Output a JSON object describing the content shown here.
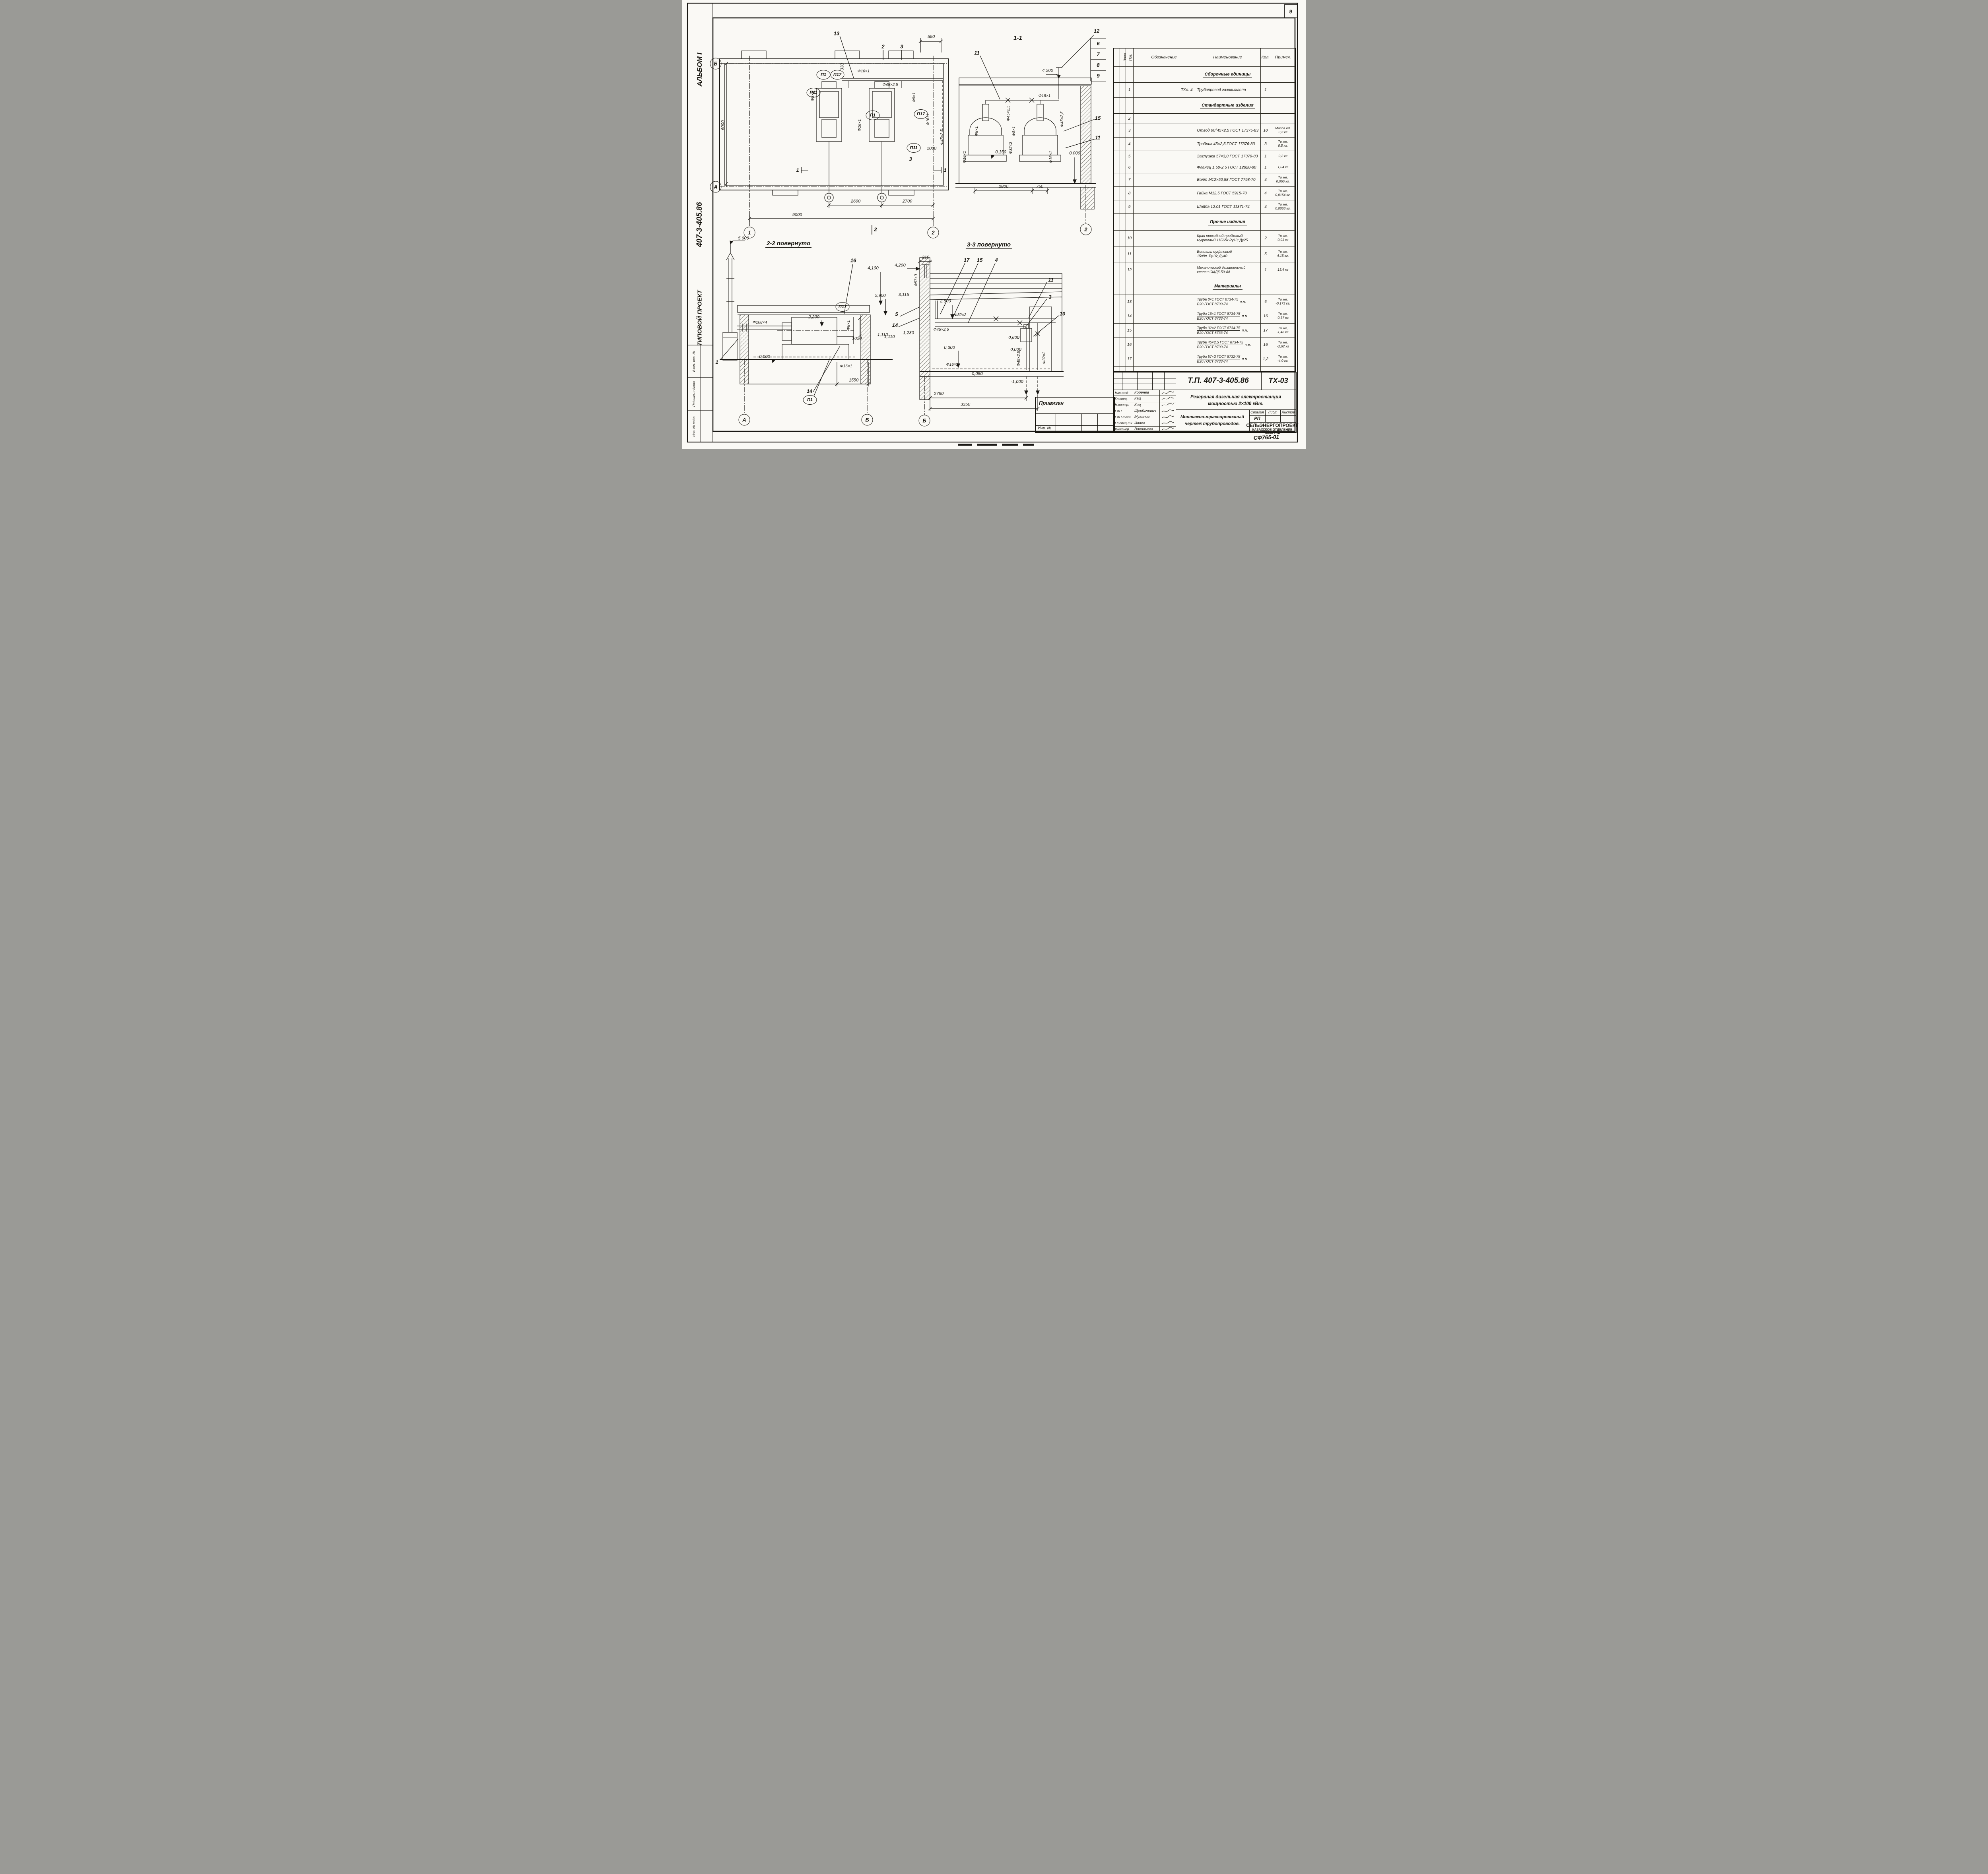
{
  "sheet": {
    "page_number": "9",
    "stamp_code": "СФ765-01"
  },
  "left_strip": {
    "album": "АЛЬБОМ I",
    "project": "407-3-405.86",
    "type": "ТИПОВОЙ ПРОЕКТ",
    "rows": [
      "Взам. инв. №",
      "Подпись и дата",
      "Инв. № подл."
    ]
  },
  "plan": {
    "c13": "13",
    "s2t": "2",
    "s3t": "3",
    "d550": "550",
    "d330": "330",
    "p16a": "Ф16×1",
    "p45a": "Ф45×2,5",
    "p8a": "Ф8×1",
    "p8b": "Ф8×1",
    "p16b": "Ф16×1",
    "p16c": "Ф16×1",
    "p45b": "Ф45×2,5",
    "u1a": "П1",
    "u17a": "П17",
    "u11a": "П11",
    "u1b": "П1",
    "u17b": "П17",
    "u11b": "П11",
    "d1000": "1000",
    "s1l": "1",
    "s1r": "1",
    "s3m": "3",
    "s2b": "2",
    "d2600": "2600",
    "d2700": "2700",
    "d9000": "9000",
    "d6000": "6000",
    "axB": "Б",
    "axA": "А",
    "ax1": "1",
    "ax2": "2"
  },
  "s11": {
    "title": "1-1",
    "c12": "12",
    "n6": "6",
    "n7": "7",
    "n8": "8",
    "n9": "9",
    "e4200": "4,200",
    "c11a": "11",
    "p18": "Ф18×1",
    "p45a": "Ф45×2,5",
    "p45b": "Ф45×2,5",
    "p8a": "Ф8×1",
    "p8b": "Ф8×1",
    "p32": "Ф32×2",
    "p16a": "Ф16×1",
    "p16b": "Ф16×1",
    "e0150": "0,150",
    "e0000": "0,000",
    "c15": "15",
    "c11b": "11",
    "d2800": "2800",
    "d750": "750",
    "ax2": "2"
  },
  "s22": {
    "title": "2-2 повернуто",
    "e5600": "5,600",
    "c16": "16",
    "e4100": "4,100",
    "e2900": "2,900",
    "u17": "П17",
    "e2200": "2,200",
    "p108": "Ф108×4",
    "p8": "Ф8×1",
    "d1020": "1020",
    "e1110": "1,110",
    "e0000": "0,000",
    "p16": "Ф16×1",
    "d1550": "1550",
    "u1": "П1",
    "c14": "14",
    "c1": "1",
    "axA": "А",
    "axB": "Б"
  },
  "s33": {
    "title": "3-3 повернуто",
    "e4200": "4,200",
    "d210": "210",
    "c17": "17",
    "c15": "15",
    "c4": "4",
    "p57": "Ф57×3",
    "e3115": "3,115",
    "e2500": "2,500",
    "c5": "5",
    "c14": "14",
    "c11": "11",
    "c3": "3",
    "c10": "10",
    "e1230": "1,230",
    "e1110": "1,110",
    "p32a": "Ф32×2",
    "p45a": "Ф45×2,5",
    "e0600": "0,600",
    "e0300": "0,300",
    "e0000": "0,000",
    "p16": "Ф16×1",
    "em0050": "-0,050",
    "p45b": "Ф45×2,5",
    "p32b": "Ф32×2",
    "em1000": "-1,000",
    "d2790": "2790",
    "d3350": "3350",
    "axB": "Б"
  },
  "spec": {
    "headers": {
      "format": "Формат",
      "zone": "Зона",
      "pos": "Поз.",
      "desig": "Обозначение",
      "name": "Наименование",
      "qty": "Кол.",
      "note": "Примеч."
    },
    "rows": [
      {
        "sec": "Сборочные единицы"
      },
      {
        "pos": "1",
        "desig": "ТХл. 4",
        "n1": "Трубопровод газовыхлопа",
        "qty": "1"
      },
      {
        "sec": "Стандартные изделия"
      },
      {
        "pos": "2"
      },
      {
        "pos": "3",
        "n1": "Отвод 90°45×2,5 ГОСТ 17375-83",
        "qty": "10",
        "no1": "Масса ед.",
        "no2": "0,3 кг"
      },
      {
        "pos": "4",
        "n1": "Тройник 45×2,5 ГОСТ 17376-83",
        "qty": "3",
        "no1": "То же,",
        "no2": "0,5 кг."
      },
      {
        "pos": "5",
        "n1": "Заглушка 57×3,0 ГОСТ 17379-83",
        "qty": "1",
        "no1": "0,2 кг"
      },
      {
        "pos": "6",
        "n1": "Фланец 1,50-2,5 ГОСТ 12820-80",
        "qty": "1",
        "no1": "1,04 кг"
      },
      {
        "pos": "7",
        "n1": "Болт М12×50,58 ГОСТ 7798-70",
        "qty": "4",
        "no1": "То же,",
        "no2": "0,056 кг."
      },
      {
        "pos": "8",
        "n1": "Гайка М12,5 ГОСТ 5915-70",
        "qty": "4",
        "no1": "То же,",
        "no2": "0,0154 кг."
      },
      {
        "pos": "9",
        "n1": "Шайба 12.01 ГОСТ 11371-74",
        "qty": "4",
        "no1": "То же,",
        "no2": "0,0063 кг."
      },
      {
        "sec": "Прочие изделия"
      },
      {
        "pos": "10",
        "n1": "Кран проходной пробковый",
        "n2": "муфтовый 11Б6бк Ру10; Ду25",
        "qty": "2",
        "no1": "То же,",
        "no2": "0,91 кг"
      },
      {
        "pos": "11",
        "n1": "Вентиль муфтовый",
        "n2": "15ч8п. Ру16; Ду40",
        "qty": "5",
        "no1": "То же,",
        "no2": "4,15 кг."
      },
      {
        "pos": "12",
        "n1": "Механический дыхательный",
        "n2": "клапан СМДК 50-4А",
        "qty": "1",
        "no1": "13,4 кг"
      },
      {
        "sec": "Материалы"
      },
      {
        "pos": "13",
        "n1": "Труба 8×1 ГОСТ 8734-75",
        "n2": "В20 ГОСТ 8733-74",
        "pm": "п.м.",
        "qty": "6",
        "no1": "То же,",
        "no2": "-0,173 кг."
      },
      {
        "pos": "14",
        "n1": "Труба 16×1 ГОСТ 8734-75",
        "n2": "В20 ГОСТ 8733-74",
        "pm": "п.м.",
        "qty": "16",
        "no1": "То же,",
        "no2": "-0,37 кг."
      },
      {
        "pos": "15",
        "n1": "Труба 32×2 ГОСТ 8734-75",
        "n2": "В20 ГОСТ 8733-74",
        "pm": "п.м.",
        "qty": "17",
        "no1": "То же,",
        "no2": "-1,48 кг."
      },
      {
        "pos": "16",
        "n1": "Труба 45×2,5 ГОСТ 8734-75",
        "n2": "В20 ГОСТ 8733-74",
        "pm": "п.м.",
        "qty": "16",
        "no1": "То же,",
        "no2": "-2,62 кг"
      },
      {
        "pos": "17",
        "n1": "Труба 57×3 ГОСТ 8732-78",
        "n2": "В20 ГОСТ 8733-74",
        "pm": "п.м.",
        "qty": "1,2",
        "no1": "То же,",
        "no2": "-4,0 кг."
      }
    ]
  },
  "tb": {
    "doc_no": "Т.П. 407-3-405.86",
    "code": "ТХ-03",
    "title1": "Резервная дизельная электростанция",
    "title2": "мощностью 2×100 кВт.",
    "dtitle1": "Монтажно-трассировочный",
    "dtitle2": "чертеж трубопроводов.",
    "org1": "СЕЛЬЭНЕРГОПРОЕКТ",
    "org2": "КАЗАХСКОЕ ОТДЕЛЕНИЕ",
    "org3": "Алма-Ата",
    "stage_l": "Стадия",
    "list_l": "Лист",
    "lists_l": "Листов",
    "stage_v": "РП",
    "roles": [
      {
        "r": "Нач.отд",
        "n": "Коренев"
      },
      {
        "r": "Гл.спец.",
        "n": "Кац"
      },
      {
        "r": "Н.контр.",
        "n": "Кац"
      },
      {
        "r": "ГИП",
        "n": "Щербачевич"
      },
      {
        "r": "ГИП техн.",
        "n": "Муханов"
      },
      {
        "r": "Гл.спец.тх",
        "n": "Ивлев"
      },
      {
        "r": "Инженер",
        "n": "Васильева"
      }
    ],
    "attached": "Привязан",
    "inv": "Инв. №"
  }
}
